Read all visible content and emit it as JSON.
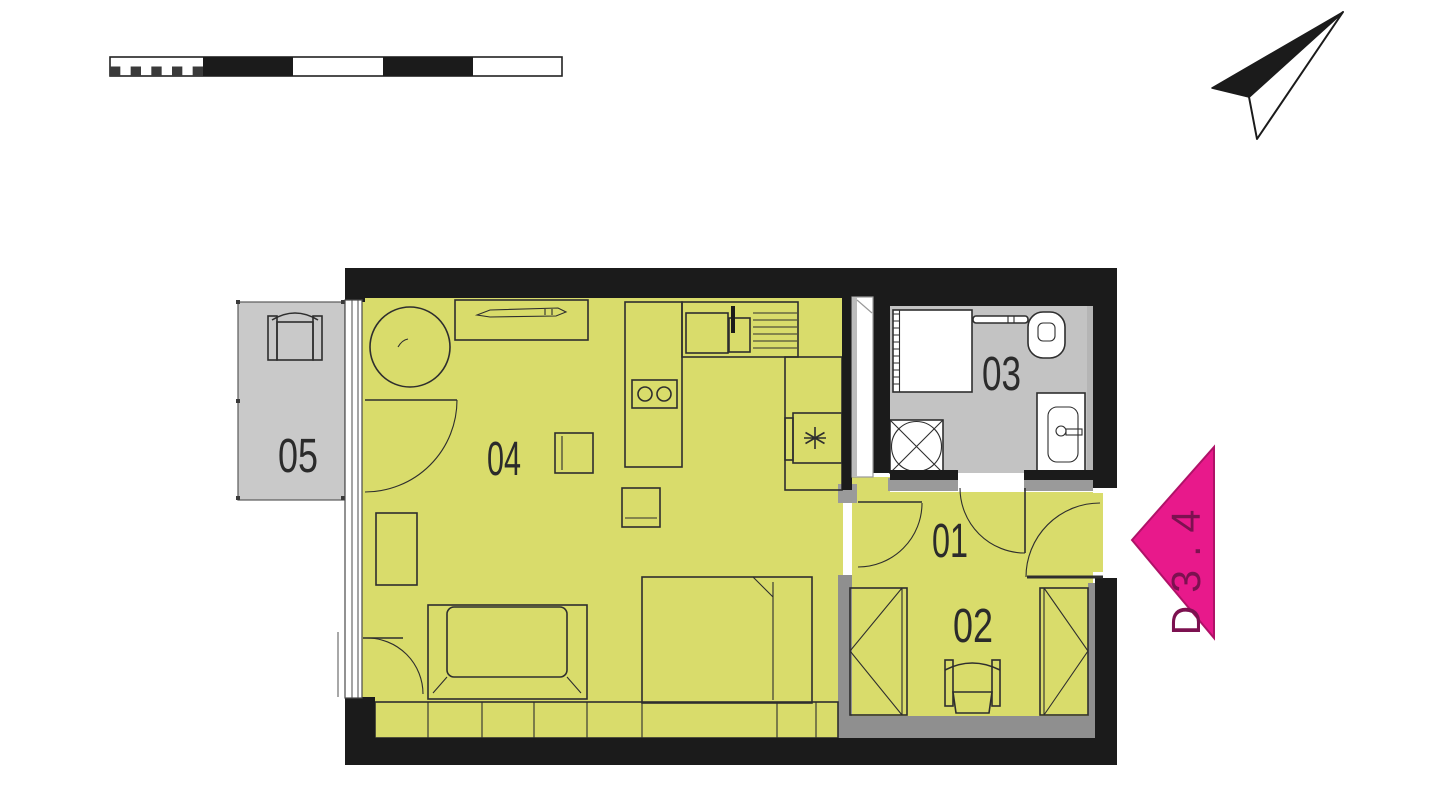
{
  "rooms": [
    {
      "label": "01"
    },
    {
      "label": "02"
    },
    {
      "label": "03"
    },
    {
      "label": "04"
    },
    {
      "label": "05"
    }
  ],
  "entrance_marker": {
    "label": "D3.4"
  },
  "colors": {
    "room-fill": "#d9dc6b",
    "wet-fill": "#c3c3c3",
    "balcony-fill": "#c9c9c9",
    "wall": "#1b1b1b",
    "threshold": "#9a9a9a",
    "partition": "#8f8f8f",
    "line": "#2e2e2e",
    "label": "#2b2b2b",
    "marker-pink": "#e8198b",
    "marker-text": "#7c1150"
  }
}
